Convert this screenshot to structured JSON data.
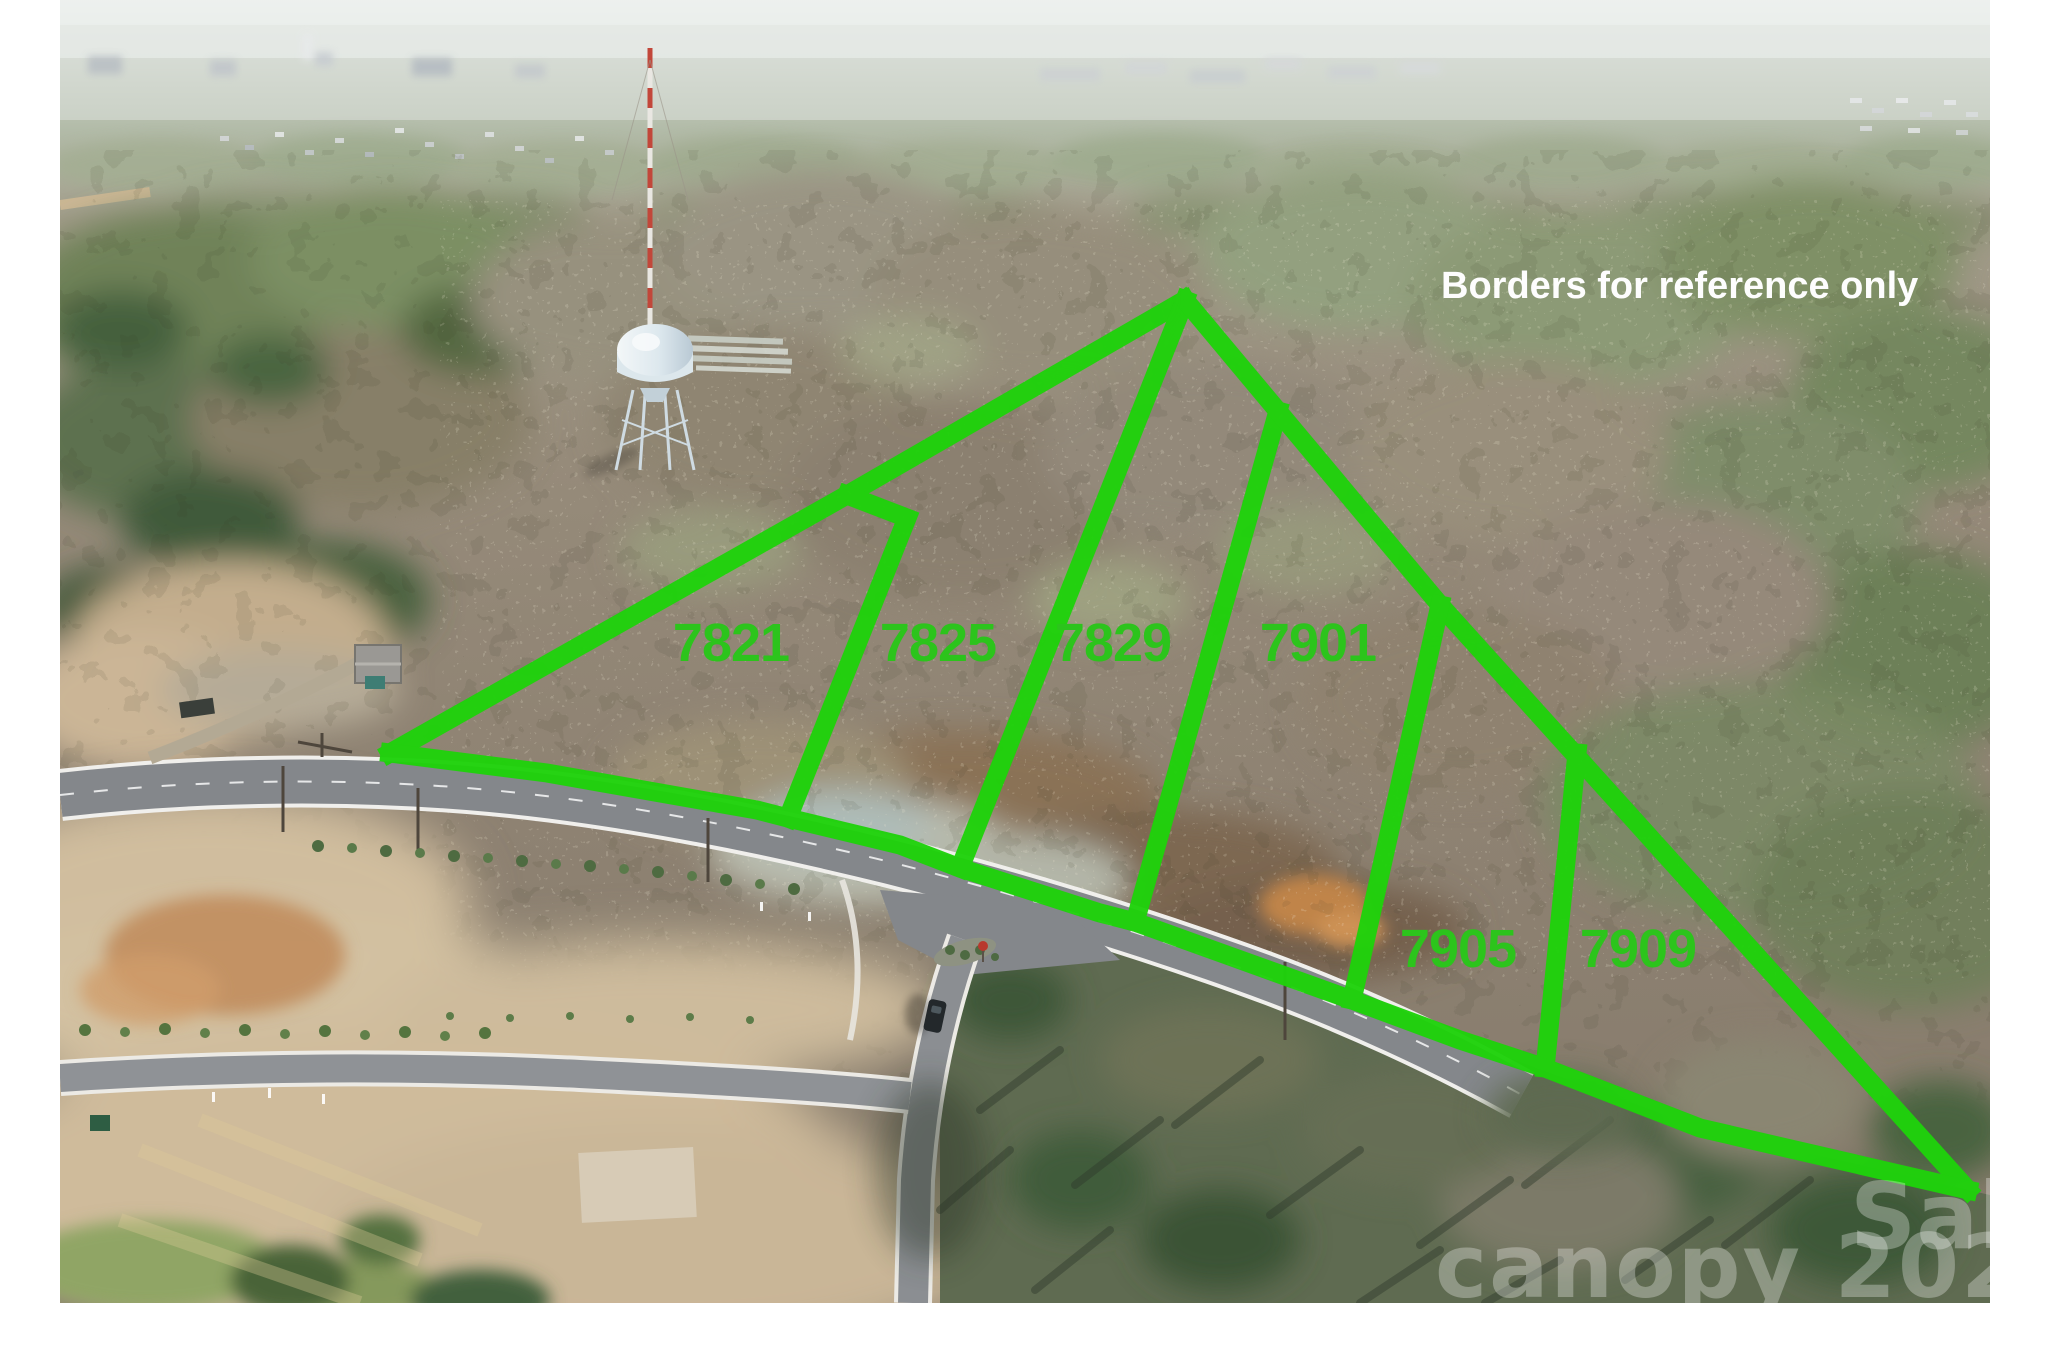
{
  "photo": {
    "disclaimer": "Borders for reference only",
    "disclaimer_color": "#fdfdfd",
    "border_color": "#1fd20c",
    "parcel_label_color": "#2cc41c",
    "parcels": [
      {
        "label": "7821"
      },
      {
        "label": "7825"
      },
      {
        "label": "7829"
      },
      {
        "label": "7901"
      },
      {
        "label": "7905"
      },
      {
        "label": "7909"
      }
    ],
    "watermark": {
      "fragment_upper": "Sal",
      "fragment_lower": "canopy 202"
    }
  }
}
